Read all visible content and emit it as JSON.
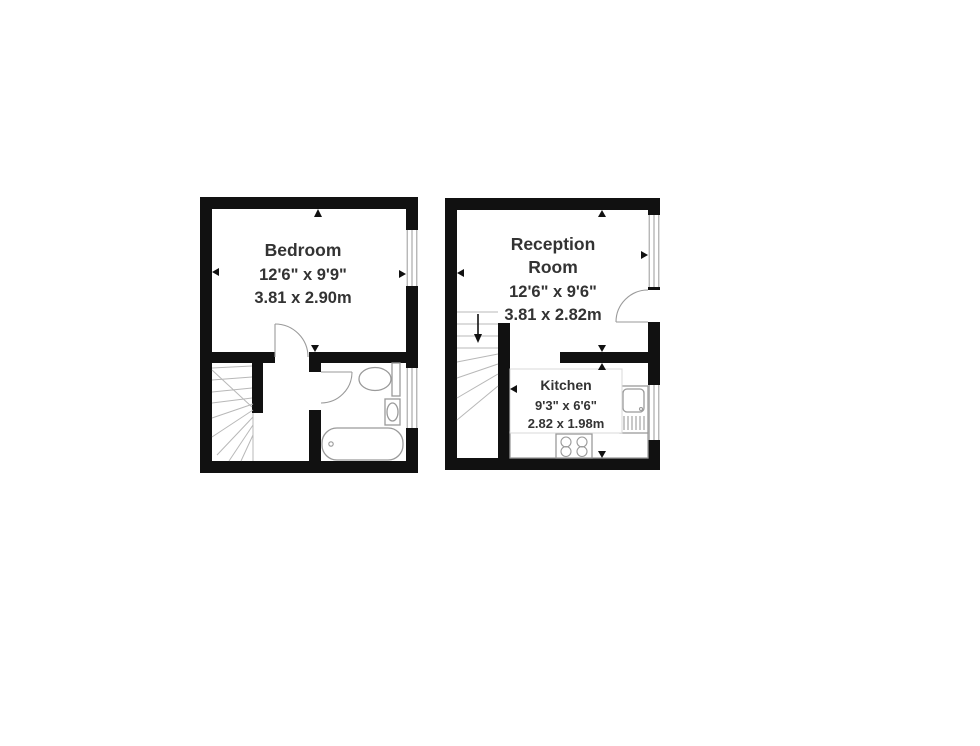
{
  "colors": {
    "background": "#ffffff",
    "wall": "#111111",
    "fixture_outline": "#9a9a9a",
    "stair_line": "#b8b8b8",
    "label_text": "#333333"
  },
  "floorplan": {
    "upper_floor": {
      "bedroom": {
        "name": "Bedroom",
        "size_imperial": "12'6\" x 9'9\"",
        "size_metric": "3.81 x 2.90m"
      }
    },
    "ground_floor": {
      "reception": {
        "name_line1": "Reception",
        "name_line2": "Room",
        "size_imperial": "12'6\" x 9'6\"",
        "size_metric": "3.81 x 2.82m"
      },
      "kitchen": {
        "name": "Kitchen",
        "size_imperial": "9'3\" x 6'6\"",
        "size_metric": "2.82 x 1.98m"
      }
    }
  }
}
